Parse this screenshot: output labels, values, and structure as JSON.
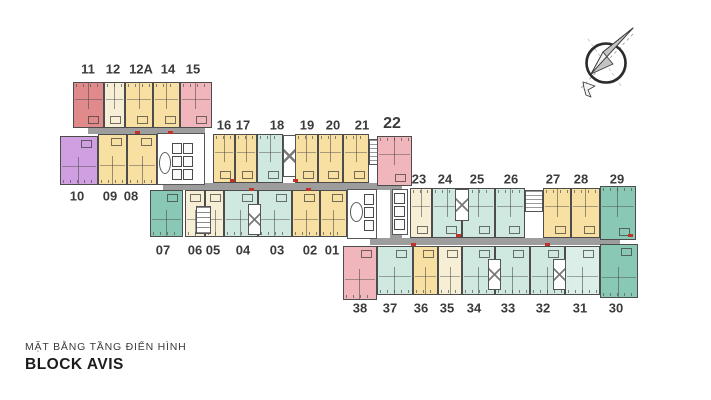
{
  "title": {
    "subtitle": "MẶT BẰNG TẦNG ĐIỂN HÌNH",
    "main": "BLOCK AVIS"
  },
  "palette": {
    "salmon": "#e18a8c",
    "pink": "#f1b6bb",
    "cream": "#f6efd5",
    "yellow": "#f8dfa2",
    "purple": "#cf9fe1",
    "mint": "#cfe8e0",
    "mintLight": "#dceee8",
    "teal": "#89c8b4",
    "corridor": "#9d9d9d",
    "wall": "#4c4c4c",
    "label": "#3b3b3b",
    "door_mark": "#c23327"
  },
  "units": [
    {
      "no": "11",
      "color": "salmon",
      "x": 73,
      "y": 82,
      "w": 31,
      "h": 46,
      "side": "top",
      "lx": 88,
      "ly": 69
    },
    {
      "no": "12",
      "color": "cream",
      "x": 104,
      "y": 82,
      "w": 21,
      "h": 46,
      "side": "top",
      "lx": 113,
      "ly": 69
    },
    {
      "no": "12A",
      "color": "yellow",
      "x": 125,
      "y": 82,
      "w": 28,
      "h": 46,
      "side": "top",
      "lx": 141,
      "ly": 69
    },
    {
      "no": "14",
      "color": "yellow",
      "x": 153,
      "y": 82,
      "w": 27,
      "h": 46,
      "side": "top",
      "lx": 168,
      "ly": 69
    },
    {
      "no": "15",
      "color": "pink",
      "x": 180,
      "y": 82,
      "w": 32,
      "h": 46,
      "side": "top",
      "lx": 193,
      "ly": 69
    },
    {
      "no": "10",
      "color": "purple",
      "x": 60,
      "y": 136,
      "w": 38,
      "h": 49,
      "side": "bottom",
      "lx": 77,
      "ly": 196
    },
    {
      "no": "09",
      "color": "yellow",
      "x": 98,
      "y": 134,
      "w": 29,
      "h": 51,
      "side": "bottom",
      "lx": 110,
      "ly": 196
    },
    {
      "no": "08",
      "color": "yellow",
      "x": 127,
      "y": 134,
      "w": 30,
      "h": 51,
      "side": "bottom",
      "lx": 131,
      "ly": 196
    },
    {
      "no": "16",
      "color": "yellow",
      "x": 213,
      "y": 134,
      "w": 22,
      "h": 49,
      "side": "top",
      "lx": 224,
      "ly": 125
    },
    {
      "no": "17",
      "color": "yellow",
      "x": 235,
      "y": 134,
      "w": 22,
      "h": 49,
      "side": "top",
      "lx": 243,
      "ly": 125
    },
    {
      "no": "18",
      "color": "mint",
      "x": 257,
      "y": 134,
      "w": 26,
      "h": 49,
      "side": "top",
      "lx": 277,
      "ly": 125
    },
    {
      "no": "19",
      "color": "yellow",
      "x": 295,
      "y": 134,
      "w": 23,
      "h": 49,
      "side": "top",
      "lx": 307,
      "ly": 125
    },
    {
      "no": "20",
      "color": "yellow",
      "x": 318,
      "y": 134,
      "w": 25,
      "h": 49,
      "side": "top",
      "lx": 333,
      "ly": 125
    },
    {
      "no": "21",
      "color": "yellow",
      "x": 343,
      "y": 134,
      "w": 26,
      "h": 49,
      "side": "top",
      "lx": 362,
      "ly": 125
    },
    {
      "no": "22",
      "color": "pink",
      "x": 377,
      "y": 136,
      "w": 35,
      "h": 50,
      "side": "top",
      "lx": 392,
      "ly": 124,
      "big": true
    },
    {
      "no": "07",
      "color": "teal",
      "x": 150,
      "y": 190,
      "w": 33,
      "h": 47,
      "side": "bottom",
      "lx": 163,
      "ly": 250
    },
    {
      "no": "06",
      "color": "cream",
      "x": 185,
      "y": 190,
      "w": 20,
      "h": 47,
      "side": "bottom",
      "lx": 195,
      "ly": 250
    },
    {
      "no": "05",
      "color": "cream",
      "x": 205,
      "y": 190,
      "w": 19,
      "h": 47,
      "side": "bottom",
      "lx": 213,
      "ly": 250
    },
    {
      "no": "04",
      "color": "mint",
      "x": 224,
      "y": 190,
      "w": 34,
      "h": 47,
      "side": "bottom",
      "lx": 243,
      "ly": 250
    },
    {
      "no": "03",
      "color": "mint",
      "x": 258,
      "y": 190,
      "w": 34,
      "h": 47,
      "side": "bottom",
      "lx": 277,
      "ly": 250
    },
    {
      "no": "02",
      "color": "yellow",
      "x": 292,
      "y": 190,
      "w": 28,
      "h": 47,
      "side": "bottom",
      "lx": 310,
      "ly": 250
    },
    {
      "no": "01",
      "color": "yellow",
      "x": 320,
      "y": 190,
      "w": 27,
      "h": 47,
      "side": "bottom",
      "lx": 332,
      "ly": 250
    },
    {
      "no": "23",
      "color": "cream",
      "x": 410,
      "y": 188,
      "w": 22,
      "h": 50,
      "side": "top",
      "lx": 419,
      "ly": 179
    },
    {
      "no": "24",
      "color": "mint",
      "x": 432,
      "y": 188,
      "w": 30,
      "h": 50,
      "side": "top",
      "lx": 445,
      "ly": 179
    },
    {
      "no": "25",
      "color": "mint",
      "x": 462,
      "y": 188,
      "w": 33,
      "h": 50,
      "side": "top",
      "lx": 477,
      "ly": 179
    },
    {
      "no": "26",
      "color": "mint",
      "x": 495,
      "y": 188,
      "w": 30,
      "h": 50,
      "side": "top",
      "lx": 511,
      "ly": 179
    },
    {
      "no": "27",
      "color": "yellow",
      "x": 543,
      "y": 188,
      "w": 28,
      "h": 50,
      "side": "top",
      "lx": 553,
      "ly": 179
    },
    {
      "no": "28",
      "color": "yellow",
      "x": 571,
      "y": 188,
      "w": 29,
      "h": 50,
      "side": "top",
      "lx": 581,
      "ly": 179
    },
    {
      "no": "29",
      "color": "teal",
      "x": 600,
      "y": 186,
      "w": 36,
      "h": 54,
      "side": "top",
      "lx": 617,
      "ly": 179
    },
    {
      "no": "38",
      "color": "pink",
      "x": 343,
      "y": 246,
      "w": 34,
      "h": 54,
      "side": "bottom",
      "lx": 360,
      "ly": 308
    },
    {
      "no": "37",
      "color": "mint",
      "x": 377,
      "y": 246,
      "w": 36,
      "h": 49,
      "side": "bottom",
      "lx": 390,
      "ly": 308
    },
    {
      "no": "36",
      "color": "yellow",
      "x": 413,
      "y": 246,
      "w": 25,
      "h": 49,
      "side": "bottom",
      "lx": 421,
      "ly": 308
    },
    {
      "no": "35",
      "color": "cream",
      "x": 438,
      "y": 246,
      "w": 24,
      "h": 49,
      "side": "bottom",
      "lx": 447,
      "ly": 308
    },
    {
      "no": "34",
      "color": "mint",
      "x": 462,
      "y": 246,
      "w": 33,
      "h": 49,
      "side": "bottom",
      "lx": 474,
      "ly": 308
    },
    {
      "no": "33",
      "color": "mint",
      "x": 495,
      "y": 246,
      "w": 35,
      "h": 49,
      "side": "bottom",
      "lx": 508,
      "ly": 308
    },
    {
      "no": "32",
      "color": "mint",
      "x": 530,
      "y": 246,
      "w": 35,
      "h": 49,
      "side": "bottom",
      "lx": 543,
      "ly": 308
    },
    {
      "no": "31",
      "color": "mintLight",
      "x": 565,
      "y": 246,
      "w": 35,
      "h": 49,
      "side": "bottom",
      "lx": 580,
      "ly": 308
    },
    {
      "no": "30",
      "color": "teal",
      "x": 600,
      "y": 244,
      "w": 38,
      "h": 54,
      "side": "bottom",
      "lx": 616,
      "ly": 308
    }
  ],
  "corridors": [
    {
      "x": 88,
      "y": 128,
      "w": 117,
      "h": 6
    },
    {
      "x": 197,
      "y": 131,
      "w": 8,
      "h": 56
    },
    {
      "x": 163,
      "y": 183,
      "w": 239,
      "h": 7
    },
    {
      "x": 390,
      "y": 186,
      "w": 12,
      "h": 56
    },
    {
      "x": 370,
      "y": 238,
      "w": 250,
      "h": 7
    }
  ],
  "cores": [
    {
      "x": 157,
      "y": 133,
      "w": 48,
      "h": 52,
      "lw": 10,
      "lh": 11,
      "oval": [
        159,
        152,
        12,
        22
      ],
      "lifts": [
        [
          172,
          143
        ],
        [
          183,
          143
        ],
        [
          172,
          156
        ],
        [
          183,
          156
        ],
        [
          172,
          169
        ],
        [
          183,
          169
        ]
      ]
    },
    {
      "x": 347,
      "y": 189,
      "w": 30,
      "h": 50,
      "lw": 10,
      "lh": 11,
      "oval": [
        350,
        202,
        13,
        20
      ],
      "lifts": [
        [
          364,
          194
        ],
        [
          364,
          207
        ],
        [
          364,
          220
        ]
      ]
    },
    {
      "x": 392,
      "y": 189,
      "w": 16,
      "h": 46,
      "lw": 11,
      "lh": 11,
      "lifts": [
        [
          394,
          193
        ],
        [
          394,
          206
        ],
        [
          394,
          219
        ]
      ]
    }
  ],
  "stairs": [
    {
      "x": 283,
      "y": 135,
      "w": 13,
      "h": 42,
      "t": "x"
    },
    {
      "x": 196,
      "y": 206,
      "w": 15,
      "h": 28,
      "t": "r"
    },
    {
      "x": 248,
      "y": 204,
      "w": 13,
      "h": 31,
      "t": "x"
    },
    {
      "x": 455,
      "y": 189,
      "w": 14,
      "h": 32,
      "t": "x"
    },
    {
      "x": 488,
      "y": 259,
      "w": 13,
      "h": 31,
      "t": "x"
    },
    {
      "x": 553,
      "y": 259,
      "w": 13,
      "h": 31,
      "t": "x"
    }
  ],
  "vents": [
    {
      "x": 369,
      "y": 139,
      "w": 9,
      "h": 26
    },
    {
      "x": 525,
      "y": 190,
      "w": 18,
      "h": 22
    }
  ],
  "door_marks": [
    {
      "x": 135,
      "y": 131
    },
    {
      "x": 168,
      "y": 131
    },
    {
      "x": 230,
      "y": 179
    },
    {
      "x": 293,
      "y": 179
    },
    {
      "x": 249,
      "y": 188
    },
    {
      "x": 306,
      "y": 188
    },
    {
      "x": 456,
      "y": 234
    },
    {
      "x": 411,
      "y": 243
    },
    {
      "x": 545,
      "y": 243
    },
    {
      "x": 628,
      "y": 234
    }
  ],
  "compass": {
    "name": "north-compass"
  }
}
